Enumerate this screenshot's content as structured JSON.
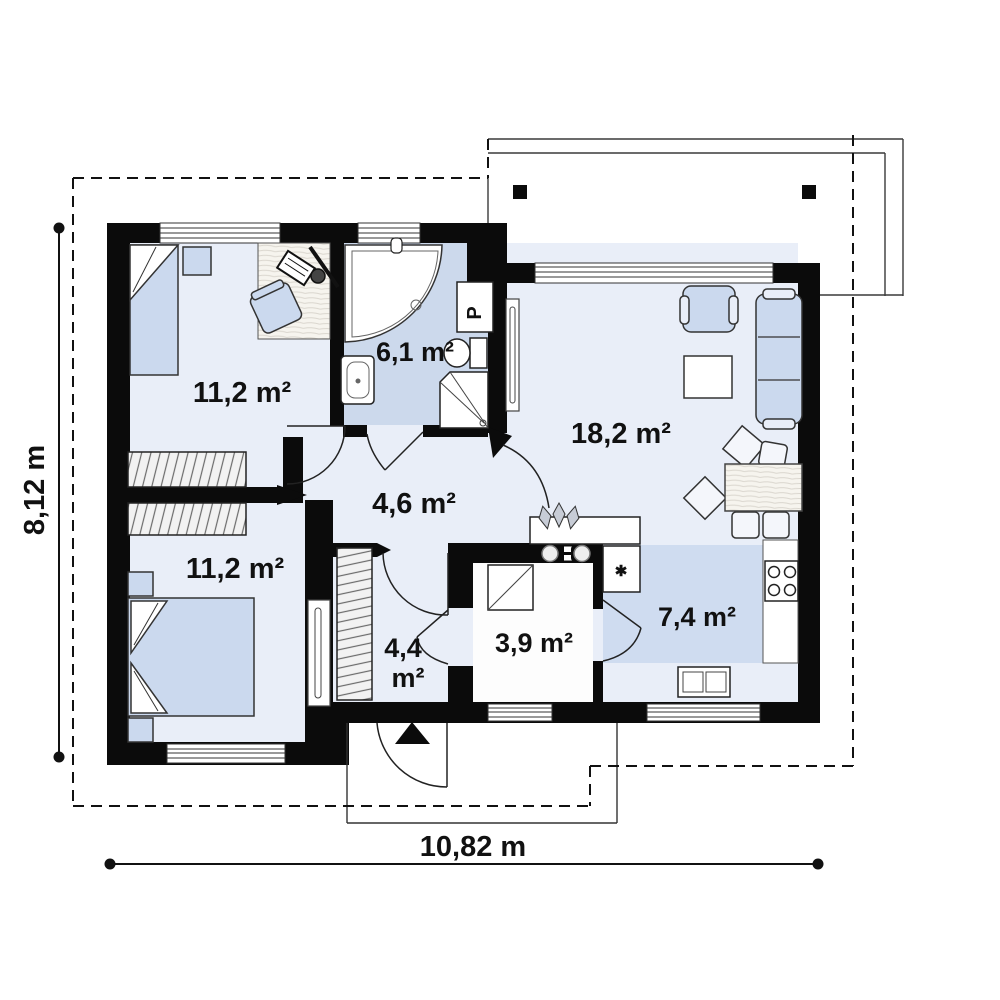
{
  "floor_plan": {
    "rooms": [
      {
        "name": "bedroom-top-left",
        "area_label": "11,2 m²"
      },
      {
        "name": "bathroom",
        "area_label": "6,1 m²"
      },
      {
        "name": "living-room",
        "area_label": "18,2 m²"
      },
      {
        "name": "hall",
        "area_label": "4,6 m²"
      },
      {
        "name": "bedroom-bottom-left",
        "area_label": "11,2 m²"
      },
      {
        "name": "entrance-hall",
        "area_line1": "4,4",
        "area_line2": "m²"
      },
      {
        "name": "storage-room",
        "area_label": "3,9 m²"
      },
      {
        "name": "kitchen",
        "area_label": "7,4 m²"
      }
    ],
    "dimensions": {
      "height_label": "8,12 m",
      "width_label": "10,82 m"
    },
    "symbols": {
      "washing_machine_label": "P",
      "appliance_star": "✱"
    },
    "colors": {
      "wall": "#0b0b0b",
      "room_fill": "#e9eef8",
      "wet_room_fill": "#ccd9ec",
      "kitchen_zone_fill": "#cfdcf0",
      "furniture_fill": "#cbd9ee",
      "outline": "#2a2a2a"
    }
  }
}
